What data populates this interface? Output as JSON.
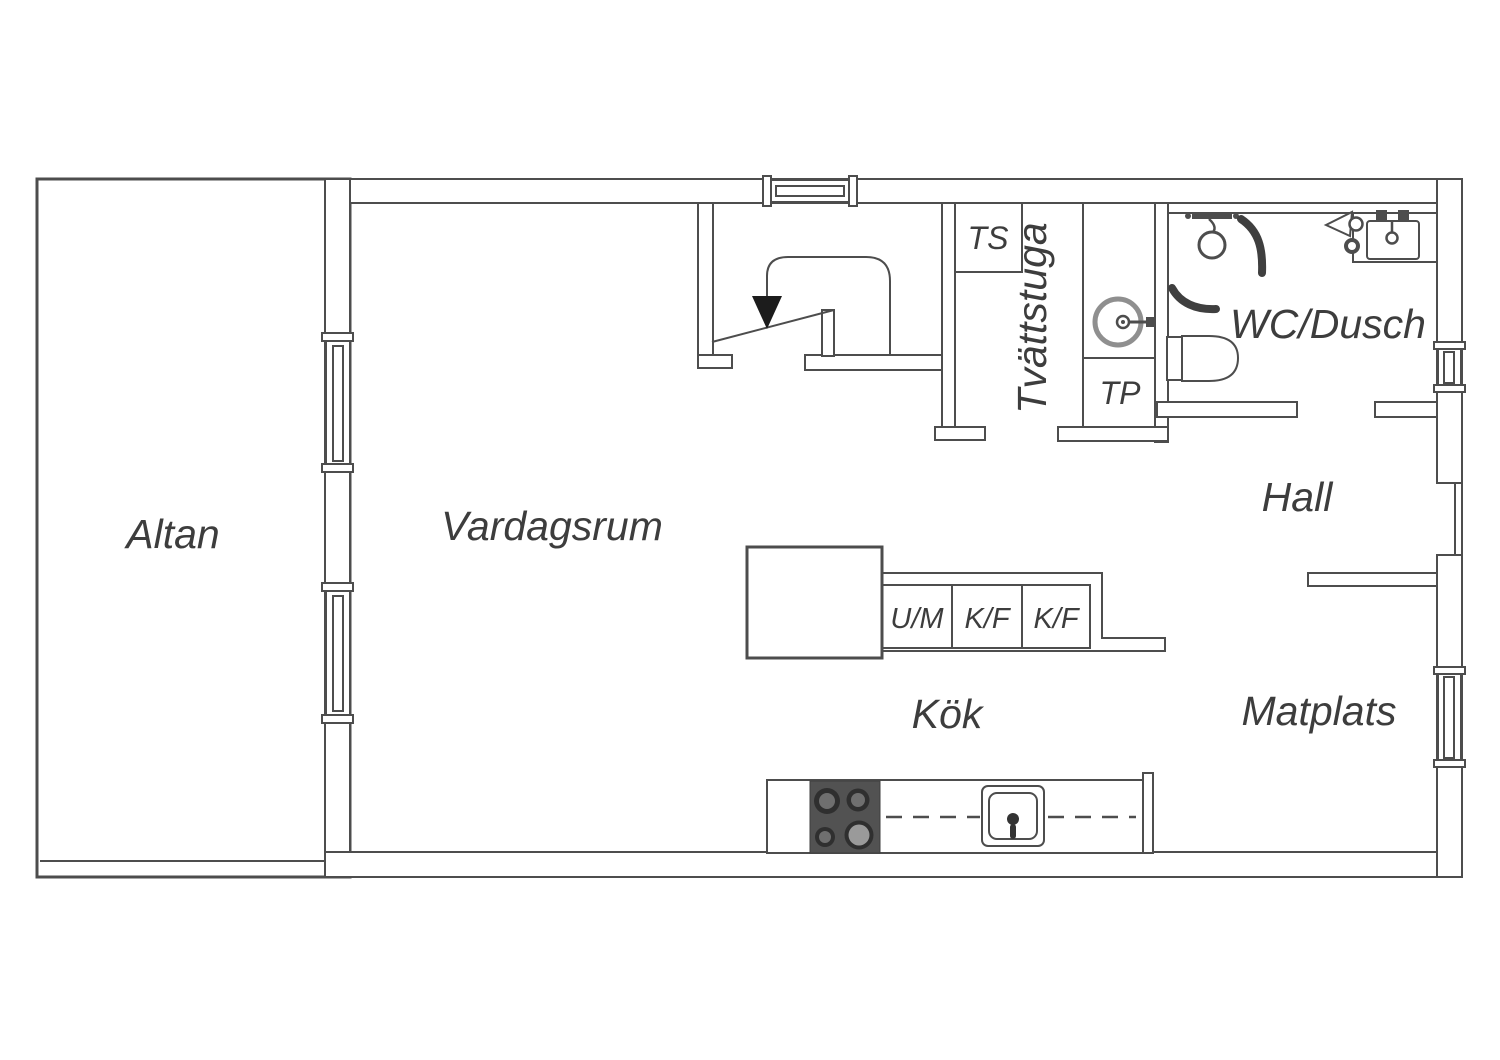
{
  "drawing": {
    "type": "floor-plan",
    "colors": {
      "background": "#ffffff",
      "line": "#4d4d4d",
      "label_text": "#3d3d3d",
      "stove_body": "#525252",
      "burner_dark": "#2f2f2f",
      "burner_mid": "#6f6f6f",
      "burner_light": "#9a9a9a",
      "washer_ring": "#8f8f8f"
    }
  },
  "rooms": {
    "altan": "Altan",
    "vardagsrum": "Vardagsrum",
    "kok": "Kök",
    "matplats": "Matplats",
    "hall": "Hall",
    "wc_dusch": "WC/Dusch",
    "tvattstuga": "Tvättstuga"
  },
  "closets": {
    "ts": "TS",
    "tp": "TP"
  },
  "appliances": {
    "um": "U/M",
    "kf1": "K/F",
    "kf2": "K/F"
  },
  "fixtures": {
    "stairs": "staircase-with-down-arrow",
    "washer": "washing-machine",
    "toilet": "toilet",
    "shower": "shower",
    "bath_sink": "bathroom-sink",
    "kitchen_island": "kitchen-island",
    "stove": "stove-cooktop",
    "kitchen_sink": "kitchen-sink"
  }
}
